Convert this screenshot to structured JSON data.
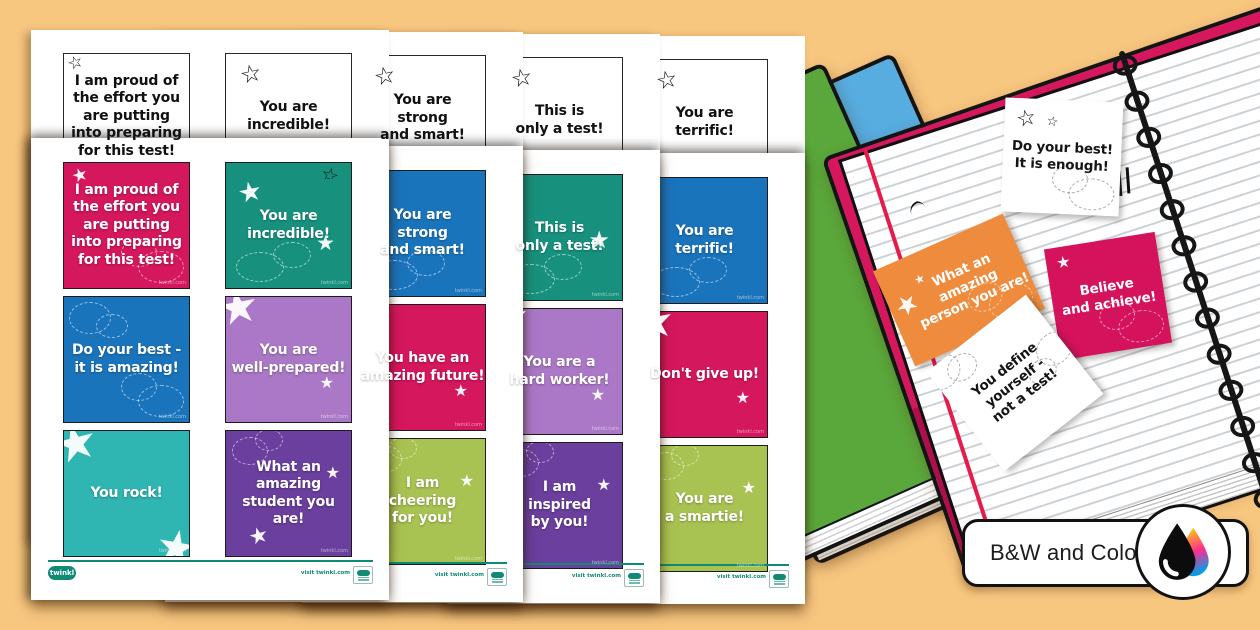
{
  "background_color": "#f7c67f",
  "accent_teal": "#0f8a75",
  "badge": {
    "label": "B&W and Color",
    "icon": "bw-color-droplet-icon"
  },
  "footer": {
    "brand": "twinkl",
    "visit": "visit twinkl.com",
    "watermark": "twinkl.com"
  },
  "pages": [
    {
      "bw_cards": [
        {
          "text": "I am proud of\nthe effort you\nare putting\ninto preparing\nfor this test!"
        },
        {
          "text": "You are\nincredible!"
        }
      ],
      "color_cards": [
        {
          "text": "I am proud of\nthe effort you\nare putting\ninto preparing\nfor this test!",
          "bg": "#d5175d"
        },
        {
          "text": "You are\nincredible!",
          "bg": "#17917e"
        },
        {
          "text": "Do your best -\nit is amazing!",
          "bg": "#1a74bc"
        },
        {
          "text": "You are\nwell-prepared!",
          "bg": "#aa78c6"
        },
        {
          "text": "You rock!",
          "bg": "#2fb5b2"
        },
        {
          "text": "What an\namazing\nstudent you are!",
          "bg": "#6a3f9d"
        }
      ]
    },
    {
      "bw_cards": [
        {
          "text": "You are\nstrong\nand smart!"
        }
      ],
      "color_cards": [
        {
          "text": "You are\nstrong\nand smart!",
          "bg": "#1a74bc"
        },
        {
          "text": "You have an\namazing future!",
          "bg": "#d5175d"
        },
        {
          "text": "I am\ncheering\nfor you!",
          "bg": "#a9c352"
        }
      ]
    },
    {
      "bw_cards": [
        {
          "text": "This is\nonly a test!"
        }
      ],
      "color_cards": [
        {
          "text": "This is\nonly a test!",
          "bg": "#17917e"
        },
        {
          "text": "You are a\nhard worker!",
          "bg": "#aa78c6"
        },
        {
          "text": "I am\ninspired\nby you!",
          "bg": "#6a3f9d"
        }
      ]
    },
    {
      "bw_cards": [
        {
          "text": "You are\nterrific!"
        }
      ],
      "color_cards": [
        {
          "text": "You are\nterrific!",
          "bg": "#1a74bc"
        },
        {
          "text": "Don't give up!",
          "bg": "#d5175d"
        },
        {
          "text": "You are\na smartie!",
          "bg": "#a9c352"
        }
      ]
    }
  ],
  "notebook_cards": [
    {
      "text": "Do your best!\nIt is enough!",
      "bg": "#ffffff"
    },
    {
      "text": "What an\namazing\nperson you are!",
      "bg": "#ef8b3d"
    },
    {
      "text": "Believe\nand achieve!",
      "bg": "#d5125c"
    },
    {
      "text": "You define\nyourself -\nnot a test!",
      "bg": "#ffffff"
    }
  ]
}
